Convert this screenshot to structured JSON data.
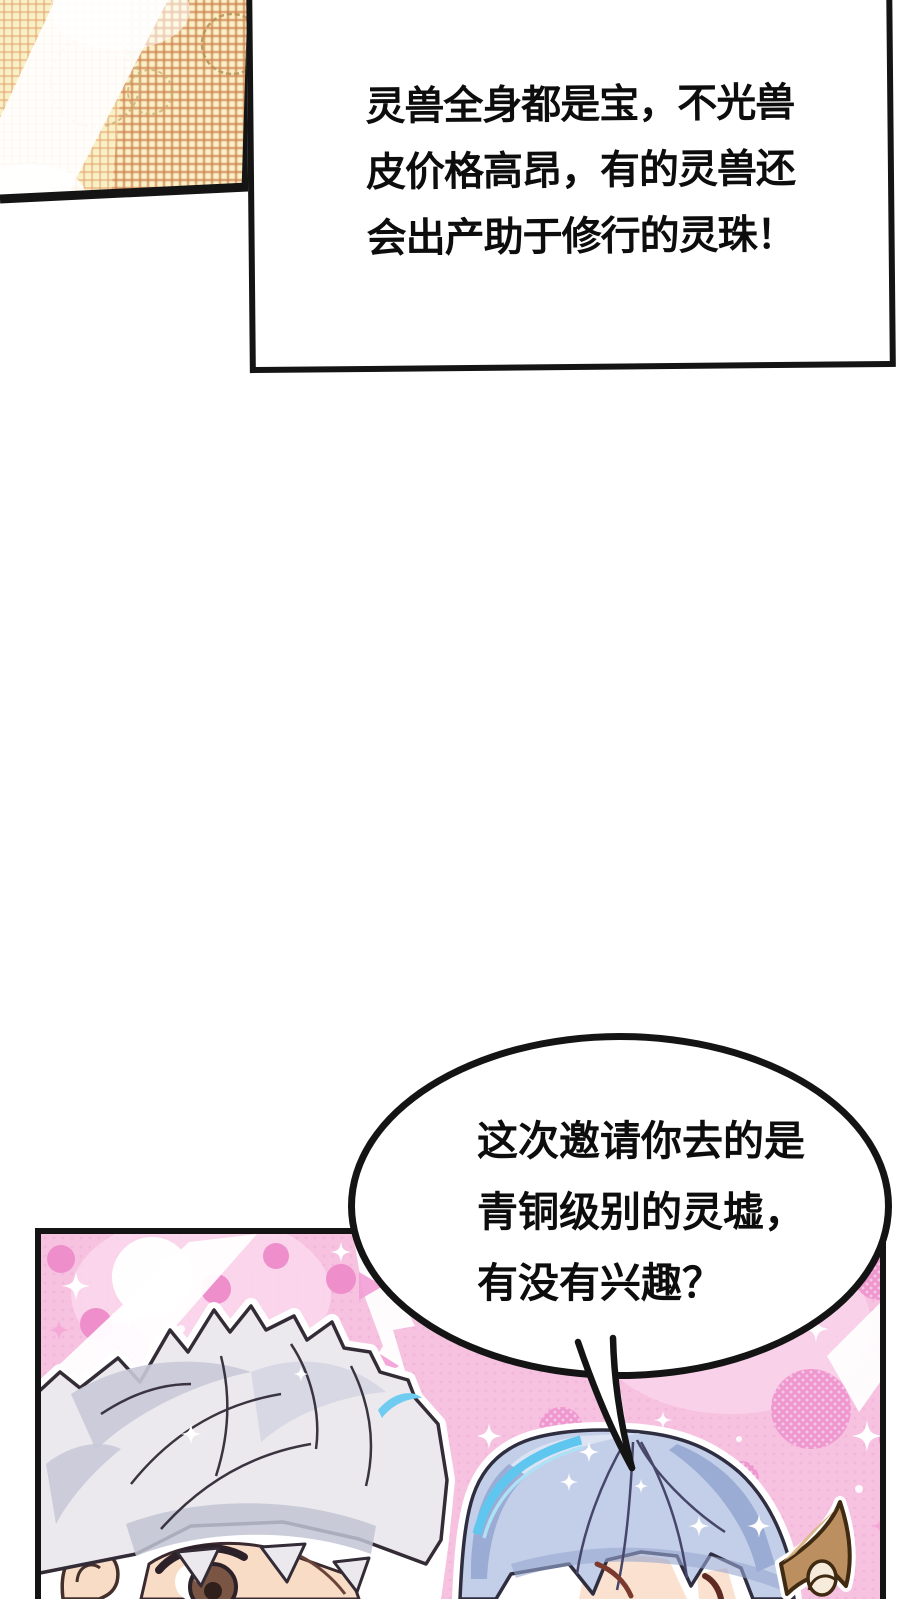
{
  "page": {
    "background": "#ffffff"
  },
  "narration_box": {
    "lines": [
      "灵兽全身都是宝，不光兽",
      "皮价格高昂，有的灵兽还",
      "会出产助于修行的灵珠！"
    ]
  },
  "speech_bubble": {
    "lines": [
      "这次邀请你去的是",
      "青铜级别的灵墟，",
      "有没有兴趣？"
    ]
  },
  "colors": {
    "ink": "#141414",
    "panel_pink": "#f6c2e0",
    "pink_dot": "#ee8fcb",
    "pink_halftone": "#ef97cf",
    "gold_cream": "#f8f1c6",
    "gold_dot": "#e5a06b",
    "silver_hair": "#ebe9ee",
    "blue_hair": "#c3cfe9",
    "cyan_highlight": "#6fccf0",
    "ear_tan": "#bb8f60",
    "skin": "#f8dcc6"
  }
}
